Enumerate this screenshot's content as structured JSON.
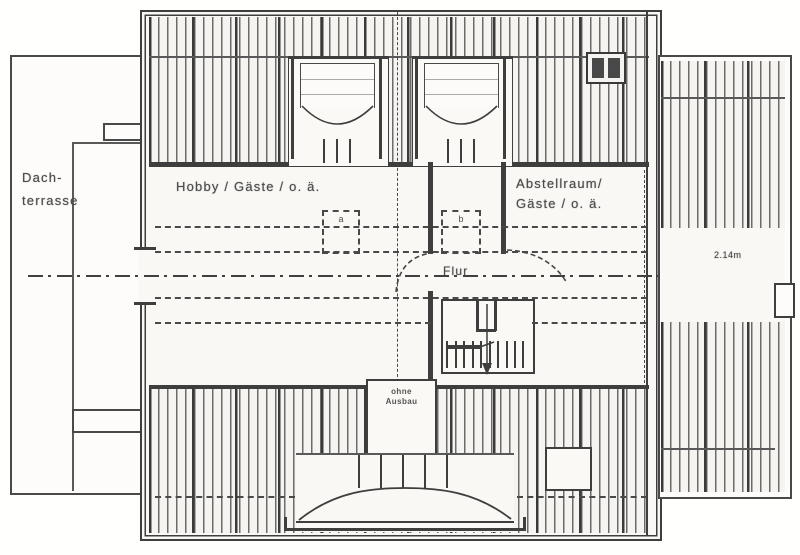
{
  "colors": {
    "line": "#3f3f3f",
    "paper": "#f7f6f3",
    "hatch_line": "#555555"
  },
  "rooms": {
    "terrace": {
      "line1": "Dach-",
      "line2": "terrasse"
    },
    "hobby": {
      "label": "Hobby / Gäste / o. ä."
    },
    "storage": {
      "line1": "Abstellraum/",
      "line2": "Gäste / o. ä."
    },
    "hall": {
      "label": "Flur"
    }
  },
  "annotations": {
    "dimension": "2.14m",
    "unfinished_line1": "ohne",
    "unfinished_line2": "Ausbau",
    "marker_a": "a",
    "marker_b": "b"
  }
}
